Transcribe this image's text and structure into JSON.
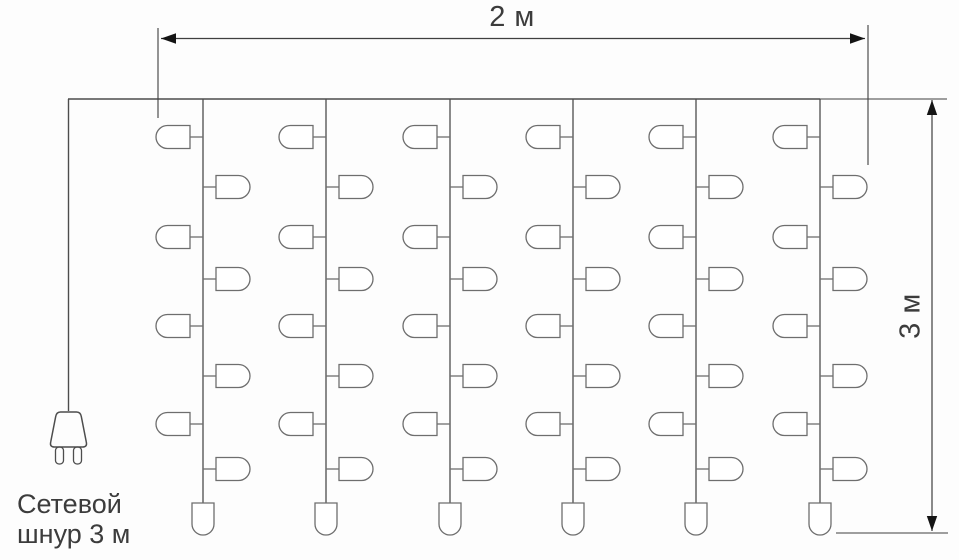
{
  "labels": {
    "width_dimension": "2 м",
    "height_dimension": "3 м",
    "power_cord_line1": "Сетевой",
    "power_cord_line2": "шнур 3 м"
  },
  "colors": {
    "background": "#fdfdfd",
    "structure_line": "#4d4d4d",
    "bulb_line": "#6e6e6e",
    "dimension_line": "#3f3f3f",
    "arrow_fill": "#141414",
    "text": "#3c3c3c"
  },
  "curtain": {
    "top_wire": {
      "x1": 68,
      "x2": 820,
      "y": 99
    },
    "strings_x": [
      203,
      326,
      450,
      573,
      696,
      820
    ],
    "string_top_y": 99,
    "string_bottom_y": 503,
    "left_bulbs_y": [
      137,
      237,
      326,
      424
    ],
    "right_bulbs_y": [
      187,
      279,
      376,
      469
    ],
    "bulb": {
      "width": 34,
      "height": 23,
      "stem": 13
    },
    "end_bulb": {
      "width": 22,
      "height": 32
    }
  },
  "power_cord": {
    "x": 68.5,
    "y1": 99,
    "y2": 411,
    "plug": {
      "cx": 68.5,
      "top_y": 412,
      "bottom_y": 447,
      "top_width": 22,
      "bottom_width": 38,
      "prong_width": 8,
      "prong_height": 17,
      "prong_gap": 10
    }
  },
  "dimensions": {
    "width": {
      "line": {
        "x1": 161,
        "x2": 865,
        "y": 38.5
      },
      "arrows": [
        {
          "x": 161,
          "y": 38.5,
          "dir": "left"
        },
        {
          "x": 865,
          "y": 38.5,
          "dir": "right"
        }
      ],
      "extension_lines": [
        {
          "x1": 158,
          "y1": 28,
          "x2": 158,
          "y2": 118
        },
        {
          "x1": 868,
          "y1": 25,
          "x2": 868,
          "y2": 165
        }
      ]
    },
    "height": {
      "line": {
        "x": 932,
        "y1": 100,
        "y2": 531
      },
      "arrows": [
        {
          "x": 932,
          "y": 100,
          "dir": "up"
        },
        {
          "x": 932,
          "y": 531,
          "dir": "down"
        }
      ],
      "extension_lines": [
        {
          "x1": 820,
          "y1": 99,
          "x2": 947,
          "y2": 99
        },
        {
          "x1": 836,
          "y1": 533,
          "x2": 948,
          "y2": 533
        }
      ]
    }
  }
}
